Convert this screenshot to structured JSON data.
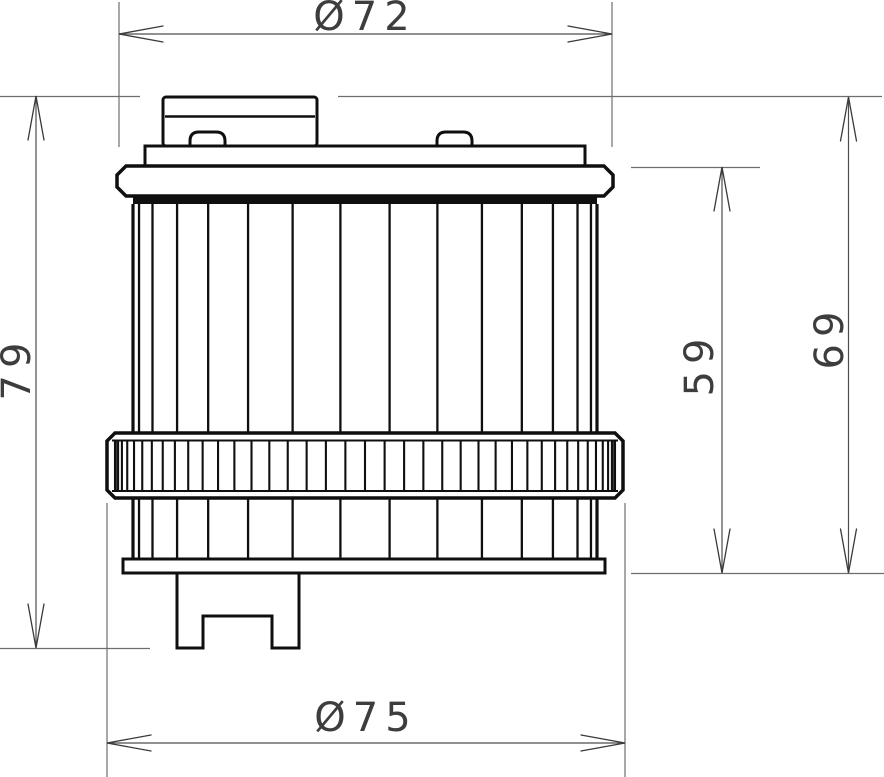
{
  "drawing": {
    "kind": "technical dimension drawing",
    "subject": "oil-filter cartridge side view"
  },
  "dimensions": {
    "diameter_top": "Ø72",
    "diameter_bottom": "Ø75",
    "height_overall": "79",
    "height_element": "59",
    "height_body": "69"
  },
  "colors": {
    "outline": "#0f0f0f",
    "dimension_line": "#4d4d4d",
    "extension_line": "#6e6e6e",
    "label_text": "#3d3d3d",
    "background": "#ffffff"
  }
}
